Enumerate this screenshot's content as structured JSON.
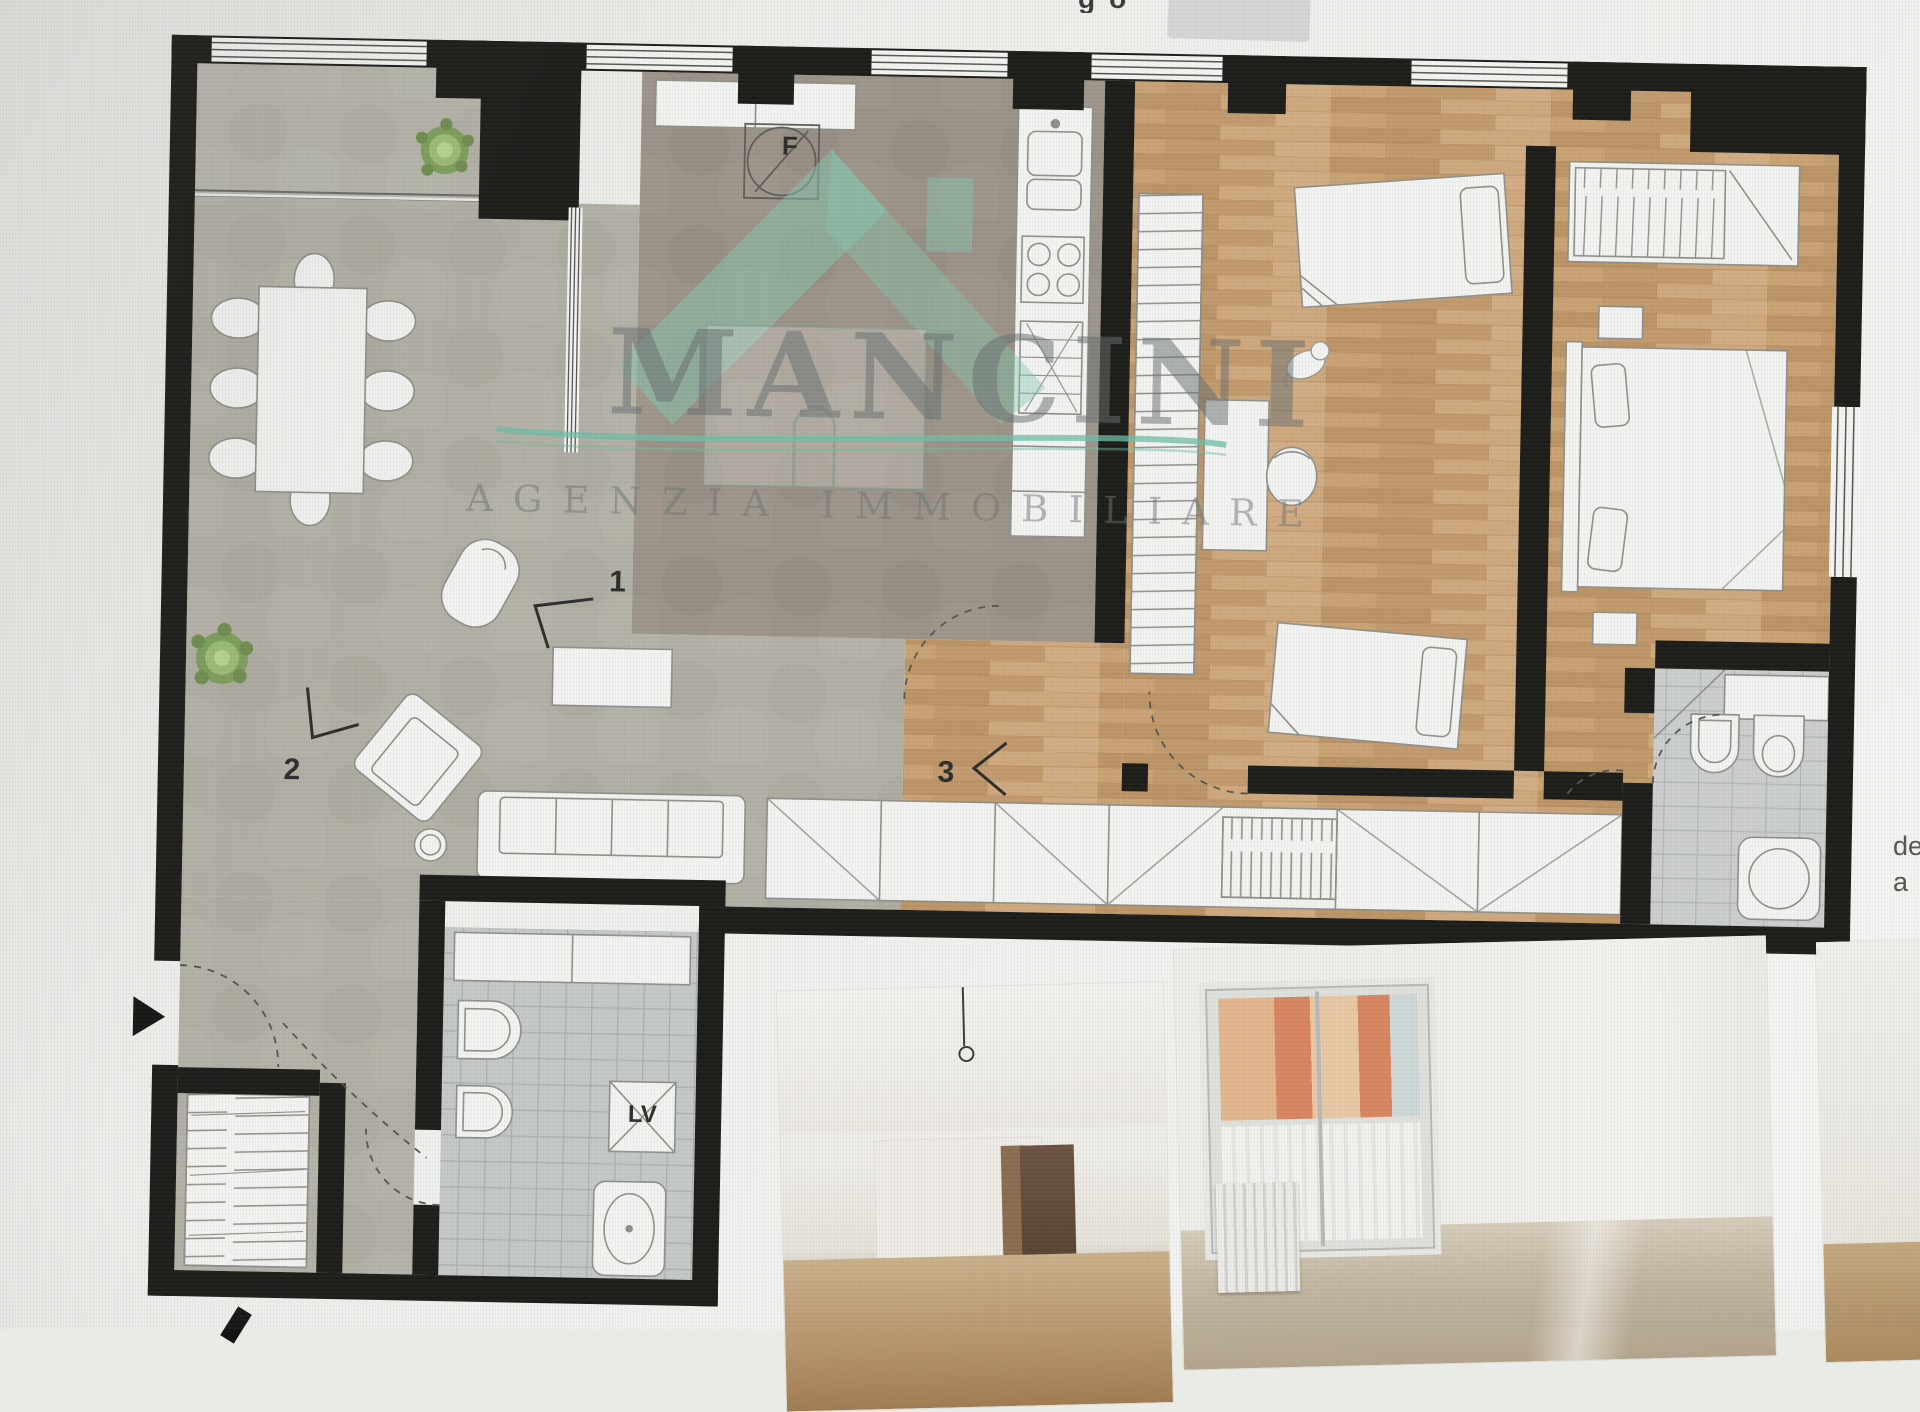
{
  "watermark": {
    "brand": "MANCINI",
    "tagline": "AGENZIA  IMMOBILIARE",
    "accent_color": "#85c3ae",
    "text_color": "#8d9496"
  },
  "floor_plan": {
    "room_labels": {
      "point_1": "1",
      "point_2": "2",
      "point_3": "3"
    },
    "symbols": {
      "fridge": "F",
      "washing_machine": "LV"
    },
    "colors": {
      "wall": "#1b1b18",
      "terrace_floor": "#a9a69c",
      "living_floor": "#b2afa5",
      "kitchen_floor": "#9b9387",
      "wood_floor": "#c6a175",
      "bath_tile": "#cbcecd",
      "furniture": "#f3f4f1",
      "plant": "#8fae6a"
    }
  },
  "screen_artifacts": {
    "top_partial_text": "go",
    "right_partial_text_line1": "de",
    "right_partial_text_line2": "a"
  },
  "photos": {
    "count": 3
  }
}
